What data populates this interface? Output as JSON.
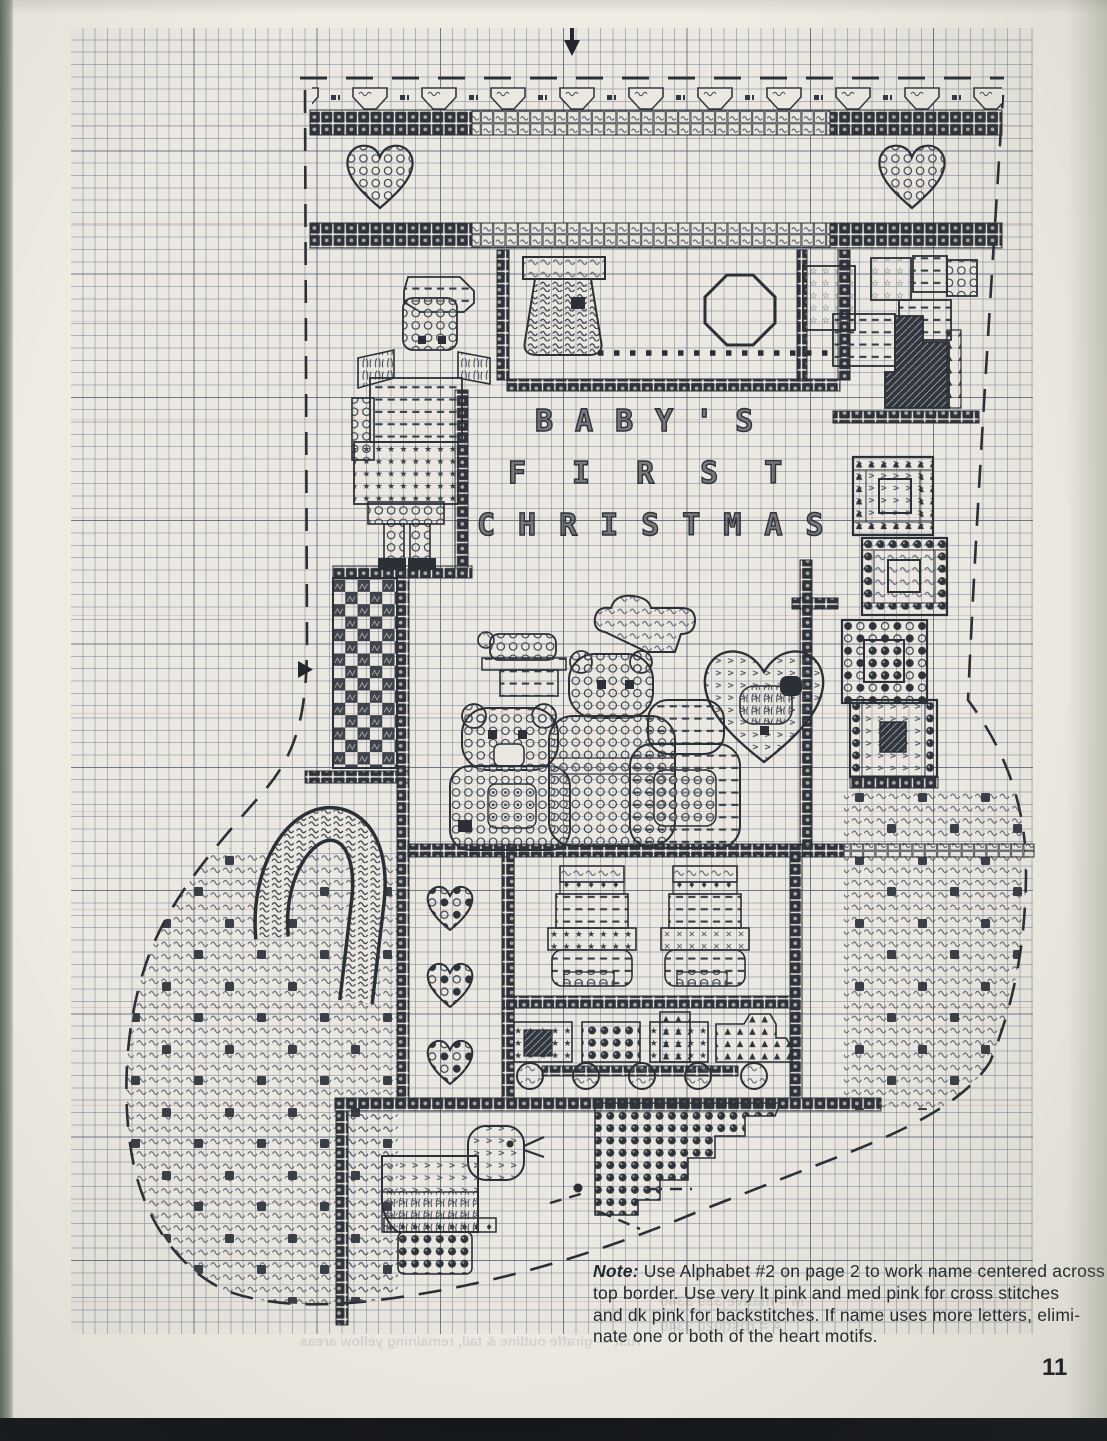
{
  "document": {
    "kind": "scanned cross-stitch chart page",
    "page_number": "11"
  },
  "chart": {
    "lettering": {
      "line1": "BABY'S",
      "line2": "FIRST",
      "line3": "CHRISTMAS"
    },
    "center_marker_top": "▼",
    "center_marker_left": "►",
    "motifs": [
      "bunting-border",
      "heart-left",
      "heart-right",
      "angel-doll",
      "stocking",
      "wreath",
      "bead-garland",
      "gift-cluster",
      "gift-boxes-column",
      "checkerboard-chimney",
      "cloud",
      "teddy-bears",
      "lamb-in-heart",
      "candy-cane",
      "small-hearts-column",
      "baby-rompers",
      "toy-train",
      "pull-toy-duck",
      "bead-stairs"
    ],
    "stitch_symbols": [
      "~",
      "★",
      "☆",
      "♦",
      "▲",
      ">",
      "—",
      "○",
      "●",
      "◇",
      "✕"
    ]
  },
  "note": {
    "label": "Note:",
    "lines": [
      "Use Alphabet #2 on page 2 to work name centered across",
      "top border. Use very lt pink and med pink for cross stitches",
      "and dk pink for backstitches. If name uses more letters, elimi-",
      "nate one or both of the heart motifs."
    ]
  },
  "bleed_through": {
    "line1": "M = mauve      339     3340",
    "line2": "A = rust     020     3340",
    "line3": "rust — giraffe outline & tail, remaining yellow areas"
  },
  "colors": {
    "paper": "#efece3",
    "grid_area": "#eae8e0",
    "grid_line": "#7c84a0",
    "ink": "#2b2f36",
    "scan_edge_left": "#5f6960",
    "scan_edge_bottom": "#121519"
  }
}
